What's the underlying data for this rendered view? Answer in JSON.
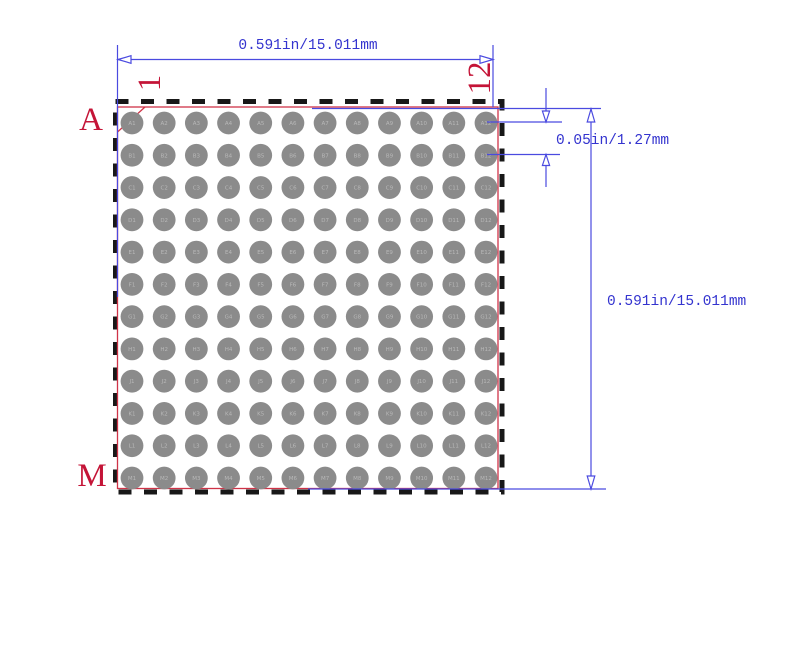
{
  "diagram": {
    "type": "bga-package-footprint",
    "grid": {
      "rows": [
        "A",
        "B",
        "C",
        "D",
        "E",
        "F",
        "G",
        "H",
        "J",
        "K",
        "L",
        "M"
      ],
      "cols": [
        "1",
        "2",
        "3",
        "4",
        "5",
        "6",
        "7",
        "8",
        "9",
        "10",
        "11",
        "12"
      ],
      "ball_count": 144
    },
    "labels": {
      "row_first": "A",
      "row_last": "M",
      "col_first": "1",
      "col_last": "12"
    },
    "dimensions": {
      "top_width": "0.591in/15.011mm",
      "right_height": "0.591in/15.011mm",
      "ball_pitch": "0.05in/1.27mm"
    },
    "colors": {
      "dimension_blue": "#4a4ae0",
      "dimension_text_blue": "#3434cf",
      "label_red": "#c41437",
      "outline_red": "#cf3347",
      "ball_gray": "#8b8b8b",
      "ball_text_gray": "#b8b8b8",
      "border_black": "#181818",
      "background": "#ffffff"
    }
  }
}
